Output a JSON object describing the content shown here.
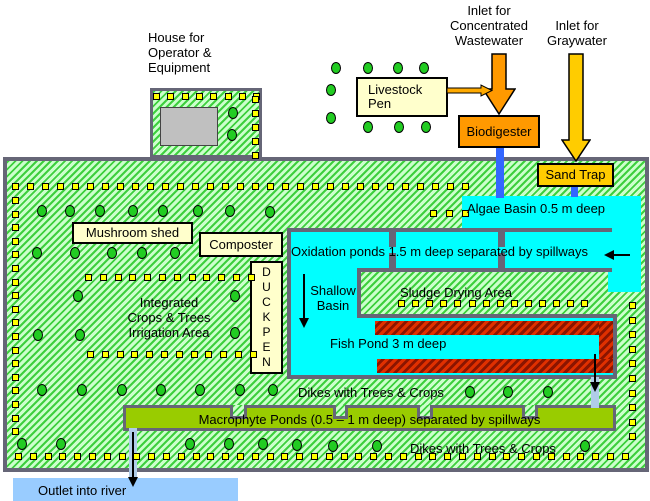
{
  "labels": {
    "house": [
      "House for",
      "Operator &",
      "Equipment"
    ],
    "inlet_concentrated": [
      "Inlet for",
      "Concentrated",
      "Wastewater"
    ],
    "inlet_graywater": [
      "Inlet for",
      "Graywater"
    ],
    "livestock_pen": [
      "Livestock",
      "Pen"
    ],
    "biodigester": "Biodigester",
    "sand_trap": "Sand Trap",
    "algae_basin": "Algae Basin 0.5 m deep",
    "oxidation_ponds": "Oxidation ponds 1.5 m deep separated by  spillways",
    "mushroom_shed": "Mushroom shed",
    "composter": "Composter",
    "duck_pen": [
      "D",
      "U",
      "C",
      "K",
      "P",
      "E",
      "N"
    ],
    "integrated_area": [
      "Integrated",
      "Crops & Trees",
      "Irrigation Area"
    ],
    "shallow_basin": [
      "Shallow",
      "Basin"
    ],
    "sludge_drying": "Sludge Drying Area",
    "fish_pond": "Fish Pond 3 m deep",
    "dikes_upper": "Dikes with Trees & Crops",
    "macrophyte_ponds": "Macrophyte Ponds (0.5 – 1 m deep) separated by spillways",
    "dikes_lower": "Dikes with Trees & Crops",
    "outlet": "Outlet into river"
  },
  "colors": {
    "land_hatch_green": "#3ecf3e",
    "land_bg": "#ccffcc",
    "water_cyan": "#00ffff",
    "pond_border_gray": "#666688",
    "biodigester_orange": "#ff9900",
    "sand_trap_gold": "#ffcc00",
    "building_pale_yellow": "#ffffcc",
    "macrophyte_olive": "#99cc00",
    "pipe_blue": "#3366ff",
    "pipe_light_blue": "#b0cce8",
    "outlet_light_blue": "#99ccff",
    "liner_red": "#cc2200",
    "tree_green": "#22cc22",
    "crop_yellow": "#ffff00",
    "roof_gray": "#c0c0c0"
  },
  "markers": {
    "square_rows": [
      {
        "x": 153,
        "y": 93,
        "n": 8,
        "dx": 14.3
      },
      {
        "x": 12,
        "y": 183,
        "n": 31,
        "dx": 15
      },
      {
        "x": 430,
        "y": 210,
        "n": 3,
        "dx": 16
      },
      {
        "x": 85,
        "y": 274,
        "n": 12,
        "dx": 14.8
      },
      {
        "x": 87,
        "y": 351,
        "n": 12,
        "dx": 14.8
      },
      {
        "x": 398,
        "y": 300,
        "n": 14,
        "dx": 14.1
      },
      {
        "x": 15,
        "y": 453,
        "n": 42,
        "dx": 14.8
      }
    ],
    "square_cols": [
      {
        "x": 252,
        "y": 96,
        "n": 5,
        "dy": 14
      },
      {
        "x": 12,
        "y": 197,
        "n": 18,
        "dy": 13.6
      },
      {
        "x": 629,
        "y": 302,
        "n": 10,
        "dy": 14.6
      }
    ],
    "tree_ovals": [
      [
        336,
        68
      ],
      [
        368,
        68
      ],
      [
        398,
        68
      ],
      [
        424,
        68
      ],
      [
        331,
        90
      ],
      [
        331,
        118
      ],
      [
        368,
        127
      ],
      [
        399,
        127
      ],
      [
        426,
        127
      ],
      [
        233,
        113
      ],
      [
        232,
        135
      ],
      [
        42,
        211
      ],
      [
        70,
        211
      ],
      [
        100,
        211
      ],
      [
        133,
        211
      ],
      [
        163,
        211
      ],
      [
        198,
        211
      ],
      [
        230,
        211
      ],
      [
        270,
        212
      ],
      [
        37,
        253
      ],
      [
        75,
        253
      ],
      [
        112,
        253
      ],
      [
        142,
        253
      ],
      [
        175,
        253
      ],
      [
        78,
        296
      ],
      [
        235,
        296
      ],
      [
        38,
        335
      ],
      [
        80,
        335
      ],
      [
        235,
        333
      ],
      [
        42,
        390
      ],
      [
        82,
        390
      ],
      [
        122,
        390
      ],
      [
        161,
        390
      ],
      [
        200,
        390
      ],
      [
        240,
        390
      ],
      [
        273,
        390
      ],
      [
        470,
        392
      ],
      [
        508,
        392
      ],
      [
        548,
        392
      ],
      [
        22,
        444
      ],
      [
        61,
        444
      ],
      [
        190,
        444
      ],
      [
        229,
        444
      ],
      [
        263,
        444
      ],
      [
        297,
        445
      ],
      [
        333,
        446
      ],
      [
        377,
        446
      ],
      [
        585,
        446
      ]
    ]
  }
}
